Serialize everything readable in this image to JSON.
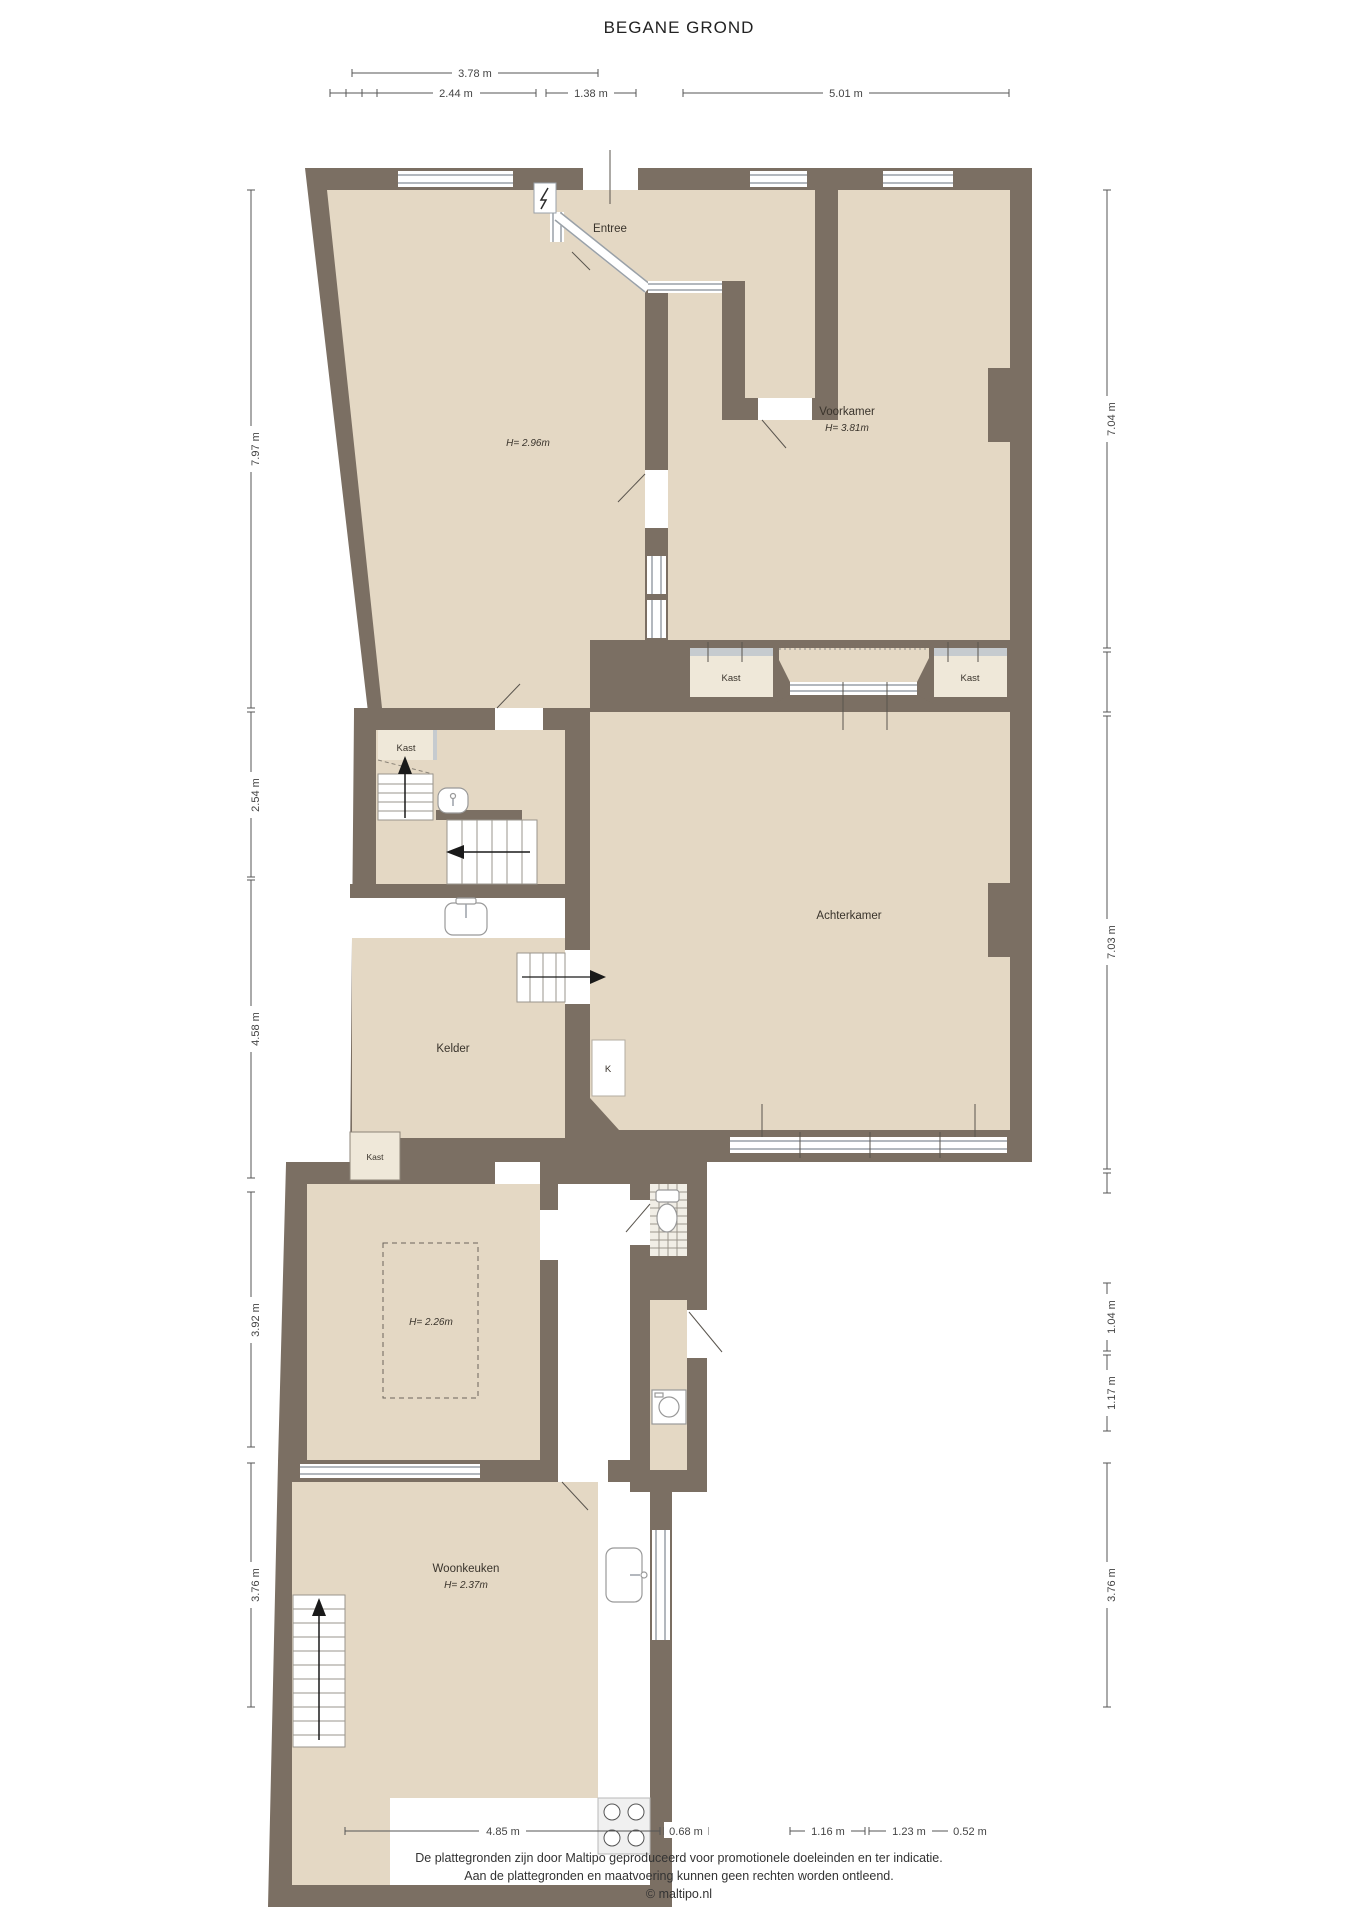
{
  "title": "BEGANE GROND",
  "rooms": {
    "entree": "Entree",
    "room1_height": "H= 2.96m",
    "voorkamer": "Voorkamer",
    "voorkamer_height": "H= 3.81m",
    "kast_ensuite_left": "Kast",
    "kast_ensuite_right": "Kast",
    "kast_hall": "Kast",
    "achterkamer": "Achterkamer",
    "kelder": "Kelder",
    "k_closet": "K",
    "kast_small": "Kast",
    "middle_room_height": "H= 2.26m",
    "woonkeuken": "Woonkeuken",
    "woonkeuken_height": "H= 2.37m"
  },
  "dims": {
    "top": [
      "3.78 m",
      "2.44 m",
      "1.38 m",
      "5.01 m"
    ],
    "left": [
      "7.97 m",
      "2.54 m",
      "4.58 m",
      "3.92 m",
      "3.76 m"
    ],
    "right": [
      "7.04 m",
      "7.03 m",
      "1.04 m",
      "1.17 m",
      "3.76 m"
    ],
    "bottom": [
      "4.85 m",
      "0.68 m",
      "1.16 m",
      "1.23 m",
      "0.52 m"
    ]
  },
  "footer": {
    "line1": "De plattegronden zijn door Maltipo geproduceerd voor promotionele doeleinden en ter indicatie.",
    "line2": "Aan de plattegronden en maatvoering kunnen geen rechten worden ontleend.",
    "line3": "© maltipo.nl"
  },
  "colors": {
    "wall": "#7b6f63",
    "floor": "#e4d8c4",
    "closet_floor": "#efe8d9",
    "window_frame": "#9aa1a8"
  },
  "icons": {
    "electric_meter": "lightning-icon",
    "stairs_up": "arrow-up",
    "stairs_down": "arrow"
  }
}
